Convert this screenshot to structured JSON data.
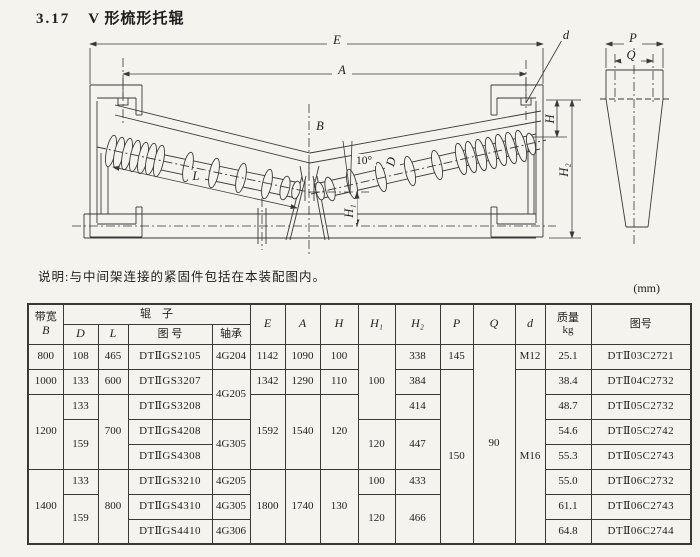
{
  "page": {
    "title_no": "3.17",
    "title": "V 形梳形托辊",
    "note": "说明:与中间架连接的紧固件包括在本装配图内。",
    "unit": "(mm)"
  },
  "drawing": {
    "labels": {
      "E": "E",
      "A": "A",
      "B": "B",
      "L": "L",
      "D": "D",
      "angle": "10°",
      "H": "H",
      "H1": "H₁",
      "H2": "H₂",
      "d": "d",
      "P": "P",
      "Q": "Q"
    }
  },
  "table": {
    "header": {
      "bandwidth": "带宽",
      "bandwidth_sym": "B",
      "roller_group": "辊　子",
      "col_d": "D",
      "col_l": "L",
      "col_fig": "图 号",
      "col_bearing": "轴承",
      "col_e": "E",
      "col_a": "A",
      "col_h": "H",
      "col_h1": "H₁",
      "col_h2": "H₂",
      "col_p": "P",
      "col_q": "Q",
      "col_dd": "d",
      "mass": "质量",
      "mass_unit": "kg",
      "col_figno": "图号"
    },
    "rows": [
      {
        "cells": [
          {
            "t": "800"
          },
          {
            "t": "108"
          },
          {
            "t": "465"
          },
          {
            "t": "DTⅡGS2105"
          },
          {
            "t": "4G204"
          },
          {
            "t": "1142"
          },
          {
            "t": "1090"
          },
          {
            "t": "100"
          },
          {
            "t": "100"
          },
          {
            "t": "338"
          },
          {
            "t": "145"
          },
          {
            "t": "90"
          },
          {
            "t": "M12"
          },
          {
            "t": "25.1"
          },
          {
            "t": "DTⅡ03C2721"
          }
        ]
      },
      {
        "cells": [
          {
            "t": "1000"
          },
          {
            "t": "133"
          },
          {
            "t": "600"
          },
          {
            "t": "DTⅡGS3207"
          },
          {
            "t": "4G205"
          },
          {
            "t": "1342"
          },
          {
            "t": "1290"
          },
          {
            "t": "110"
          },
          {
            "t": "384"
          },
          {
            "t": "150"
          },
          {
            "t": "M16"
          },
          {
            "t": "38.4"
          },
          {
            "t": "DTⅡ04C2732"
          }
        ]
      },
      {
        "cells": [
          {
            "t": "1200"
          },
          {
            "t": "133"
          },
          {
            "t": "700"
          },
          {
            "t": "DTⅡGS3208"
          },
          {
            "t": "1592"
          },
          {
            "t": "1540"
          },
          {
            "t": "120"
          },
          {
            "t": "414"
          },
          {
            "t": "48.7"
          },
          {
            "t": "DTⅡ05C2732"
          }
        ]
      },
      {
        "cells": [
          {
            "t": "159"
          },
          {
            "t": "DTⅡGS4208"
          },
          {
            "t": "4G305"
          },
          {
            "t": "120"
          },
          {
            "t": "447"
          },
          {
            "t": "54.6"
          },
          {
            "t": "DTⅡ05C2742"
          }
        ]
      },
      {
        "cells": [
          {
            "t": "DTⅡGS4308"
          },
          {
            "t": "55.3"
          },
          {
            "t": "DTⅡ05C2743"
          }
        ]
      },
      {
        "cells": [
          {
            "t": "1400"
          },
          {
            "t": "133"
          },
          {
            "t": "800"
          },
          {
            "t": "DTⅡGS3210"
          },
          {
            "t": "4G205"
          },
          {
            "t": "1800"
          },
          {
            "t": "1740"
          },
          {
            "t": "130"
          },
          {
            "t": "100"
          },
          {
            "t": "433"
          },
          {
            "t": "55.0"
          },
          {
            "t": "DTⅡ06C2732"
          }
        ]
      },
      {
        "cells": [
          {
            "t": "159"
          },
          {
            "t": "DTⅡGS4310"
          },
          {
            "t": "4G305"
          },
          {
            "t": "120"
          },
          {
            "t": "466"
          },
          {
            "t": "61.1"
          },
          {
            "t": "DTⅡ06C2743"
          }
        ]
      },
      {
        "cells": [
          {
            "t": "DTⅡGS4410"
          },
          {
            "t": "4G306"
          },
          {
            "t": "64.8"
          },
          {
            "t": "DTⅡ06C2744"
          }
        ]
      }
    ]
  }
}
